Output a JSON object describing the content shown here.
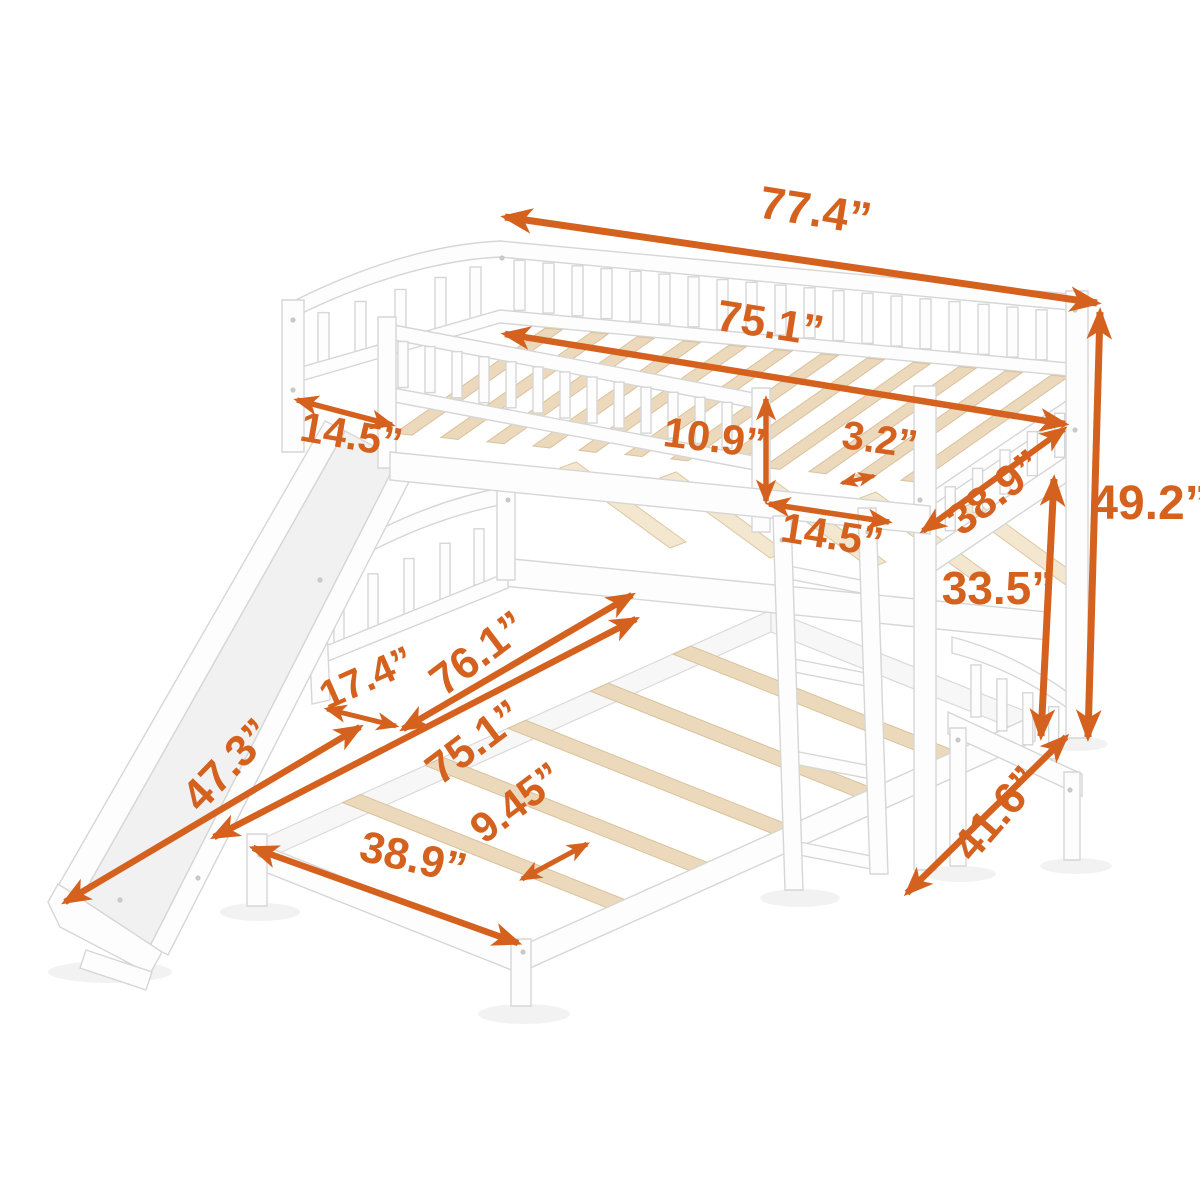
{
  "figure": {
    "title": "Bunk bed with slide, ladder and trundle - dimension diagram",
    "background_color": "#ffffff",
    "accent_color": "#d4611e",
    "wood_color": "#ecd9bb",
    "frame_color": "#fdfdfd",
    "unit": "inches"
  },
  "dimensions": [
    {
      "id": "overall-length",
      "label": "77.4”",
      "value": 77.4,
      "x": 813,
      "y": 226,
      "rotate": 9,
      "size": 46,
      "sw": 7,
      "arrow": {
        "x1": 505,
        "y1": 217,
        "x2": 1097,
        "y2": 303
      }
    },
    {
      "id": "top-bed-length",
      "label": "75.1”",
      "value": 75.1,
      "x": 768,
      "y": 338,
      "rotate": 9,
      "size": 44,
      "sw": 6.5,
      "arrow": {
        "x1": 505,
        "y1": 334,
        "x2": 1065,
        "y2": 424
      }
    },
    {
      "id": "slide-width",
      "label": "14.5”",
      "value": 14.5,
      "x": 349,
      "y": 449,
      "rotate": 10,
      "size": 42,
      "sw": 5.5,
      "arrow": {
        "x1": 297,
        "y1": 400,
        "x2": 392,
        "y2": 425
      }
    },
    {
      "id": "guardrail-height",
      "label": "10.9”",
      "value": 10.9,
      "x": 713,
      "y": 452,
      "rotate": 7,
      "size": 42,
      "sw": 5.5,
      "arrow": {
        "x1": 766,
        "y1": 399,
        "x2": 766,
        "y2": 501
      }
    },
    {
      "id": "slat-thickness",
      "label": "3.2”",
      "value": 3.2,
      "x": 878,
      "y": 453,
      "rotate": 8,
      "size": 40,
      "sw": 4,
      "arrow": {
        "x1": 842,
        "y1": 483,
        "x2": 874,
        "y2": 476
      }
    },
    {
      "id": "top-bed-width",
      "label": "38.9”",
      "value": 38.9,
      "x": 1004,
      "y": 504,
      "rotate": -38,
      "size": 44,
      "sw": 6,
      "arrow": {
        "x1": 923,
        "y1": 531,
        "x2": 1064,
        "y2": 429
      }
    },
    {
      "id": "ladder-width",
      "label": "14.5”",
      "value": 14.5,
      "x": 830,
      "y": 549,
      "rotate": 9,
      "size": 42,
      "sw": 5.5,
      "arrow": {
        "x1": 769,
        "y1": 504,
        "x2": 889,
        "y2": 522
      }
    },
    {
      "id": "overall-height",
      "label": "49.2”",
      "value": 49.2,
      "x": 1150,
      "y": 519,
      "rotate": 0,
      "size": 48,
      "sw": 7,
      "arrow": {
        "x1": 1100,
        "y1": 312,
        "x2": 1088,
        "y2": 737
      }
    },
    {
      "id": "bunk-clearance",
      "label": "33.5”",
      "value": 33.5,
      "x": 998,
      "y": 604,
      "rotate": 0,
      "size": 46,
      "sw": 7,
      "arrow": {
        "x1": 1054,
        "y1": 479,
        "x2": 1041,
        "y2": 736
      }
    },
    {
      "id": "lower-bed-width",
      "label": "41.6”",
      "value": 41.6,
      "x": 1008,
      "y": 823,
      "rotate": -49,
      "size": 44,
      "sw": 6.5,
      "arrow": {
        "x1": 1066,
        "y1": 737,
        "x2": 907,
        "y2": 893
      }
    },
    {
      "id": "slide-clearance",
      "label": "17.4”",
      "value": 17.4,
      "x": 372,
      "y": 690,
      "rotate": -24,
      "size": 40,
      "sw": 5,
      "arrow": {
        "x1": 327,
        "y1": 709,
        "x2": 396,
        "y2": 726
      }
    },
    {
      "id": "lower-length-overall",
      "label": "76.1”",
      "value": 76.1,
      "x": 487,
      "y": 665,
      "rotate": -37,
      "size": 44,
      "sw": 6.5,
      "arrow": {
        "x1": 403,
        "y1": 729,
        "x2": 632,
        "y2": 595
      }
    },
    {
      "id": "trundle-length",
      "label": "75.1”",
      "value": 75.1,
      "x": 483,
      "y": 754,
      "rotate": -37,
      "size": 44,
      "sw": 6.5,
      "arrow": {
        "x1": 214,
        "y1": 837,
        "x2": 636,
        "y2": 619
      }
    },
    {
      "id": "slide-length",
      "label": "47.3”",
      "value": 47.3,
      "x": 238,
      "y": 775,
      "rotate": -46,
      "size": 44,
      "sw": 6.5,
      "arrow": {
        "x1": 65,
        "y1": 902,
        "x2": 360,
        "y2": 727
      }
    },
    {
      "id": "slat-spacing",
      "label": "9.45”",
      "value": 9.45,
      "x": 525,
      "y": 814,
      "rotate": -37,
      "size": 42,
      "sw": 5,
      "arrow": {
        "x1": 522,
        "y1": 879,
        "x2": 587,
        "y2": 844
      }
    },
    {
      "id": "trundle-width",
      "label": "38.9”",
      "value": 38.9,
      "x": 410,
      "y": 872,
      "rotate": 13,
      "size": 44,
      "sw": 6.5,
      "arrow": {
        "x1": 253,
        "y1": 848,
        "x2": 518,
        "y2": 943
      }
    }
  ]
}
